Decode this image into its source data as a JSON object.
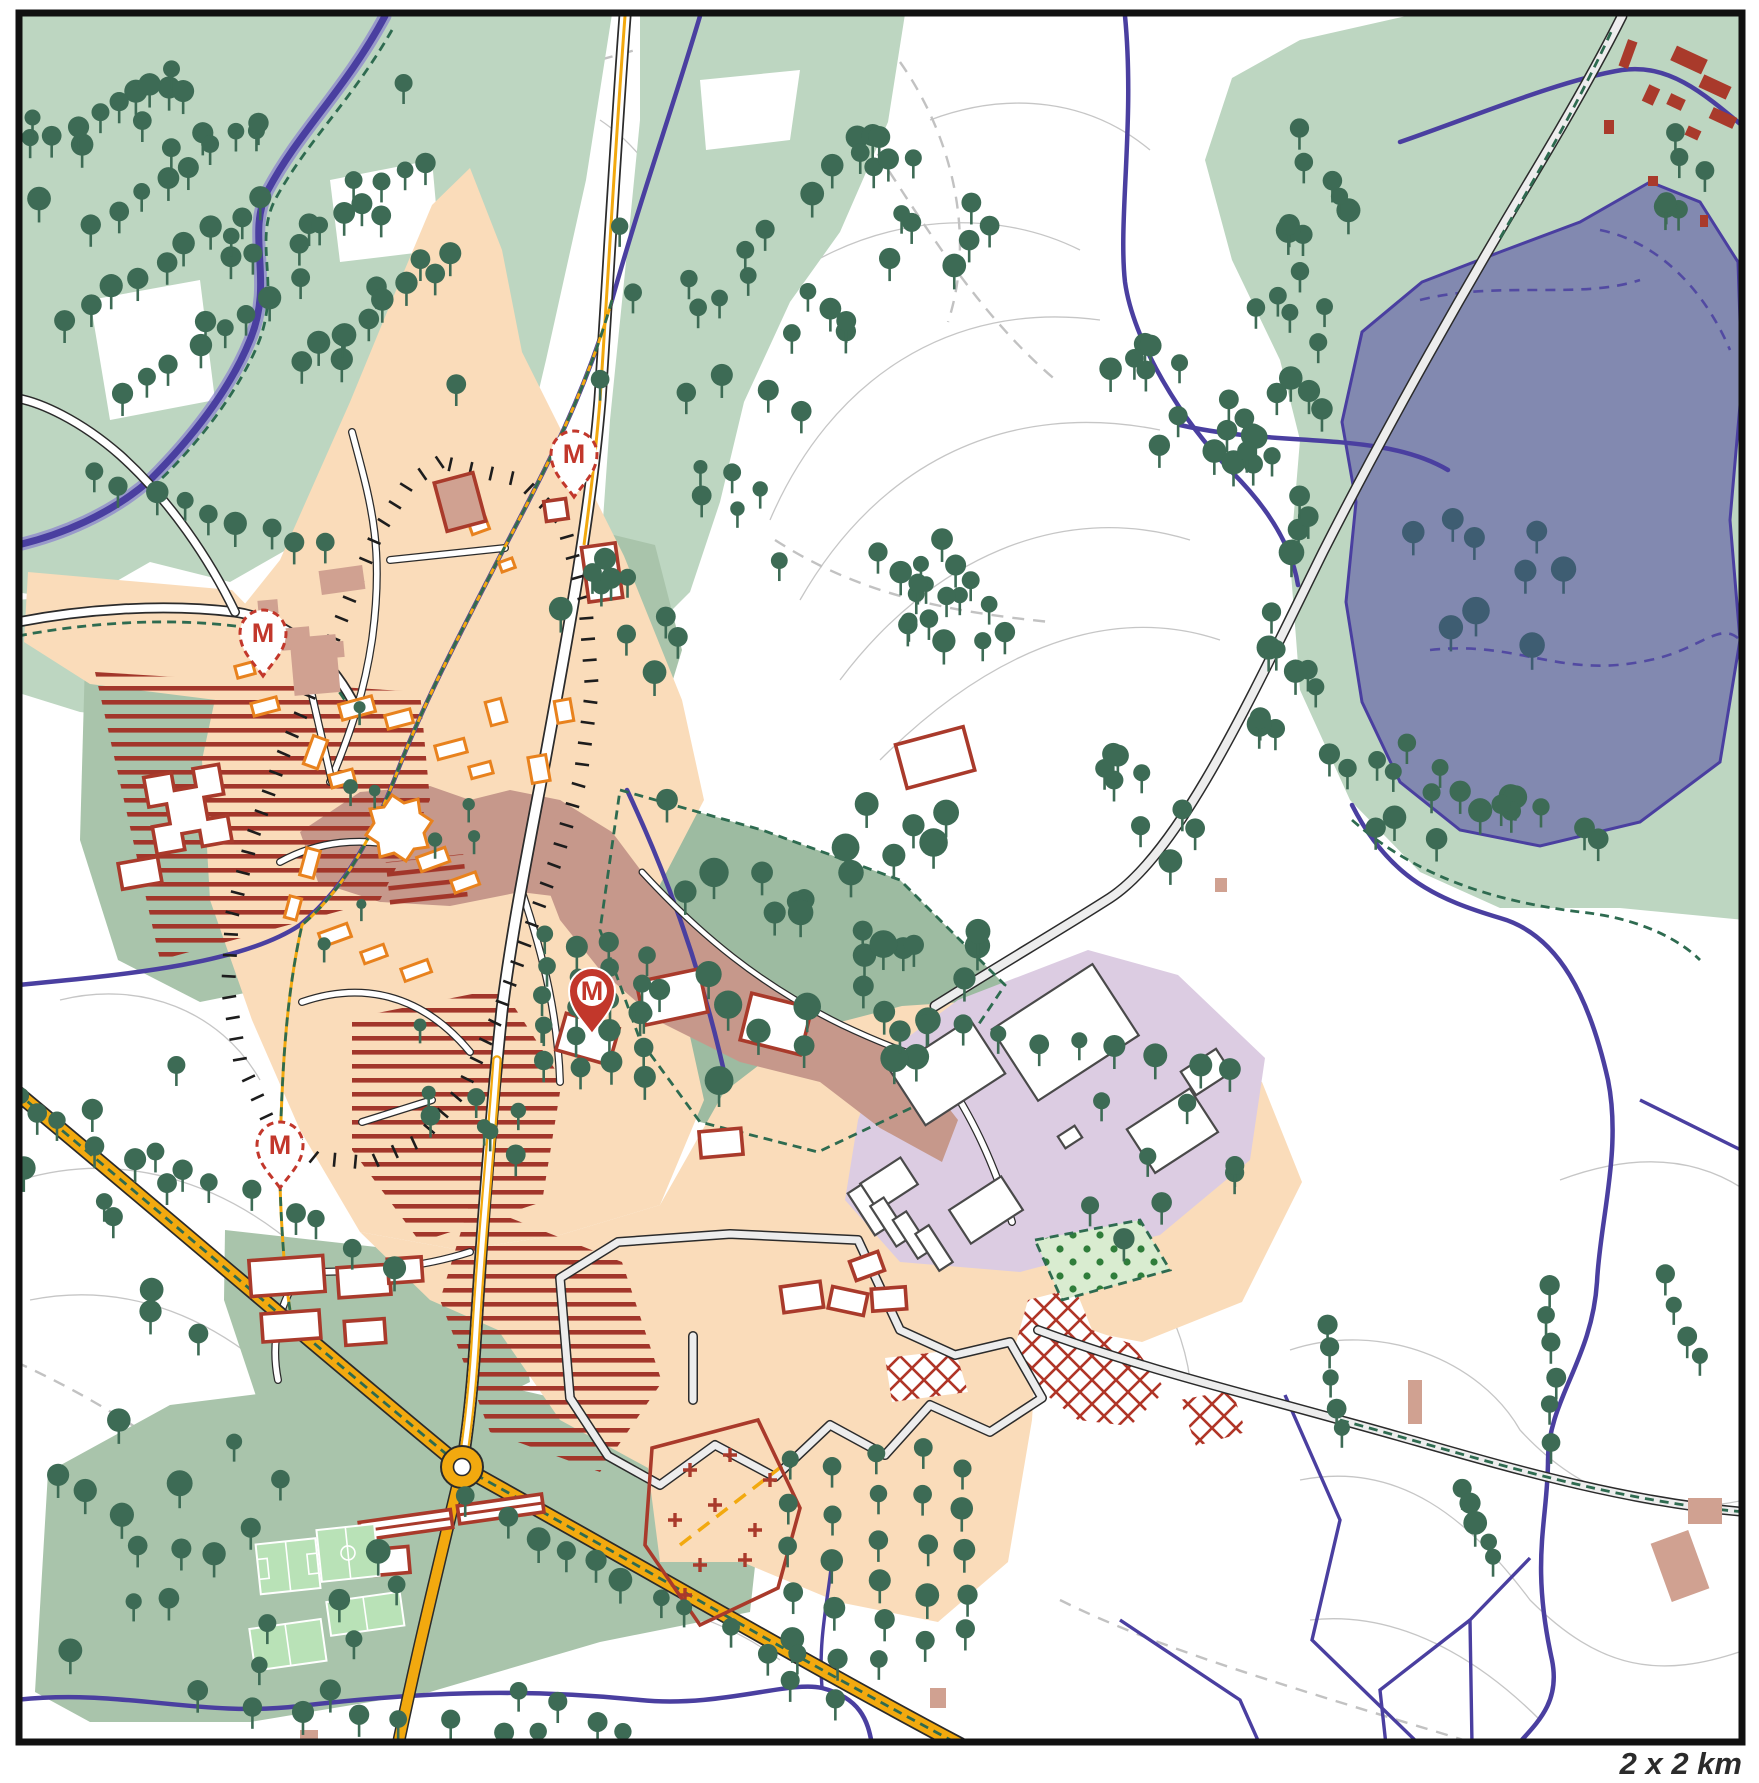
{
  "map": {
    "scale_label": "2 x 2 km",
    "marker_letter": "M",
    "markers": [
      {
        "x": 574,
        "y": 497,
        "style": "dashed"
      },
      {
        "x": 263,
        "y": 676,
        "style": "dashed"
      },
      {
        "x": 280,
        "y": 1188,
        "style": "dashed"
      },
      {
        "x": 592,
        "y": 1034,
        "style": "solid"
      }
    ],
    "colors": {
      "paper": "#ffffff",
      "frame": "#111111",
      "forest": "#bdd6c1",
      "park": "#a9c4ab",
      "parkDense": "#9dbba1",
      "lake": "#8289b0",
      "lakeLine": "#4a3fa0",
      "river": "#4a3fa0",
      "riverHalo": "#8d85cc",
      "roadYellow": "#f2a90f",
      "roadCase": "#2b2b2b",
      "roadPale": "#ededed",
      "urban": "#fadcba",
      "urbanOld": "#c6988b",
      "industrial": "#dccce2",
      "bldOrange": "#e8821e",
      "bldRed": "#a93a2b",
      "bldRose": "#d0a191",
      "pitch": "#b9e2b7",
      "orchard": "#d9ecd0",
      "orchardDot": "#2f7d3a",
      "tree": "#3d6b55",
      "treeSlate": "#3e5d72",
      "contour": "#c6c6c6",
      "dashGreen": "#2e6b50",
      "dashGray": "#c2c2c2",
      "hatchRed": "#a2362a",
      "tick": "#1d1d1d",
      "markerRed": "#c2372b",
      "scaleText": "#2b2b2b"
    },
    "tick_loop": {
      "gap": 21,
      "len": 14,
      "points": [
        [
          440,
          462
        ],
        [
          520,
          480
        ],
        [
          562,
          520
        ],
        [
          585,
          600
        ],
        [
          592,
          690
        ],
        [
          580,
          780
        ],
        [
          556,
          860
        ],
        [
          526,
          940
        ],
        [
          496,
          1020
        ],
        [
          462,
          1090
        ],
        [
          420,
          1140
        ],
        [
          370,
          1163
        ],
        [
          315,
          1158
        ],
        [
          268,
          1120
        ],
        [
          240,
          1060
        ],
        [
          228,
          990
        ],
        [
          232,
          915
        ],
        [
          252,
          838
        ],
        [
          280,
          762
        ],
        [
          308,
          698
        ],
        [
          332,
          642
        ],
        [
          354,
          588
        ],
        [
          378,
          532
        ],
        [
          408,
          484
        ],
        [
          440,
          462
        ]
      ]
    },
    "tree_clusters": [
      {
        "t": "s",
        "x": 30,
        "y": 55,
        "w": 430,
        "h": 370,
        "n": 24,
        "sd": 1,
        "r1": 8,
        "r2": 12
      },
      {
        "t": "r",
        "x1": 55,
        "y1": 140,
        "x2": 170,
        "y2": 68,
        "n": 6,
        "sd": 2,
        "j": 6
      },
      {
        "t": "r",
        "x1": 95,
        "y1": 225,
        "x2": 255,
        "y2": 118,
        "n": 8,
        "sd": 3,
        "j": 6
      },
      {
        "t": "r",
        "x1": 65,
        "y1": 320,
        "x2": 262,
        "y2": 202,
        "n": 9,
        "sd": 4,
        "j": 6
      },
      {
        "t": "r",
        "x1": 122,
        "y1": 392,
        "x2": 300,
        "y2": 278,
        "n": 8,
        "sd": 5,
        "j": 6
      },
      {
        "t": "r",
        "x1": 298,
        "y1": 242,
        "x2": 422,
        "y2": 158,
        "n": 7,
        "sd": 6,
        "j": 6
      },
      {
        "t": "r",
        "x1": 300,
        "y1": 362,
        "x2": 452,
        "y2": 258,
        "n": 8,
        "sd": 7,
        "j": 6
      },
      {
        "t": "r",
        "x1": 95,
        "y1": 470,
        "x2": 330,
        "y2": 548,
        "n": 9,
        "sd": 8,
        "j": 8
      },
      {
        "t": "s",
        "x": 600,
        "y": 225,
        "w": 255,
        "h": 205,
        "n": 18,
        "sd": 9,
        "r1": 8,
        "r2": 12
      },
      {
        "t": "s",
        "x": 808,
        "y": 118,
        "w": 200,
        "h": 195,
        "n": 16,
        "sd": 10,
        "r1": 8,
        "r2": 12
      },
      {
        "t": "r",
        "x1": 882,
        "y1": 548,
        "x2": 948,
        "y2": 638,
        "n": 5,
        "sd": 11,
        "j": 5
      },
      {
        "t": "r",
        "x1": 938,
        "y1": 540,
        "x2": 1002,
        "y2": 628,
        "n": 5,
        "sd": 12,
        "j": 5
      },
      {
        "t": "s",
        "x": 1090,
        "y": 330,
        "w": 170,
        "h": 160,
        "n": 12,
        "sd": 13,
        "r1": 8,
        "r2": 12
      },
      {
        "t": "s",
        "x": 1280,
        "y": 108,
        "w": 95,
        "h": 155,
        "n": 8,
        "sd": 14,
        "r1": 8,
        "r2": 13
      },
      {
        "t": "s",
        "x": 1243,
        "y": 250,
        "w": 100,
        "h": 175,
        "n": 10,
        "sd": 15,
        "r1": 8,
        "r2": 13
      },
      {
        "t": "s",
        "x": 1222,
        "y": 420,
        "w": 95,
        "h": 175,
        "n": 10,
        "sd": 16,
        "r1": 8,
        "r2": 13
      },
      {
        "t": "s",
        "x": 1250,
        "y": 590,
        "w": 105,
        "h": 170,
        "n": 10,
        "sd": 17,
        "r1": 8,
        "r2": 13
      },
      {
        "t": "s",
        "x": 1330,
        "y": 728,
        "w": 135,
        "h": 122,
        "n": 10,
        "sd": 18,
        "r1": 8,
        "r2": 13
      },
      {
        "t": "s",
        "x": 1462,
        "y": 788,
        "w": 150,
        "h": 92,
        "n": 8,
        "sd": 19,
        "r1": 8,
        "r2": 13
      },
      {
        "t": "s",
        "x": 1658,
        "y": 118,
        "w": 85,
        "h": 112,
        "n": 6,
        "sd": 20,
        "r1": 8,
        "r2": 12
      },
      {
        "t": "s",
        "x": 1390,
        "y": 468,
        "w": 180,
        "h": 195,
        "n": 9,
        "sd": 21,
        "r1": 10,
        "r2": 15,
        "c": "slate"
      },
      {
        "t": "s",
        "x": 1068,
        "y": 740,
        "w": 140,
        "h": 160,
        "n": 9,
        "sd": 22,
        "r1": 8,
        "r2": 12
      },
      {
        "t": "s",
        "x": 898,
        "y": 552,
        "w": 112,
        "h": 92,
        "n": 8,
        "sd": 23,
        "r1": 7,
        "r2": 10
      },
      {
        "t": "s",
        "x": 640,
        "y": 798,
        "w": 350,
        "h": 285,
        "n": 36,
        "sd": 24,
        "r1": 10,
        "r2": 15
      },
      {
        "t": "s",
        "x": 558,
        "y": 542,
        "w": 132,
        "h": 172,
        "n": 10,
        "sd": 25,
        "r1": 8,
        "r2": 12
      },
      {
        "t": "s",
        "x": 292,
        "y": 658,
        "w": 330,
        "h": 380,
        "n": 10,
        "sd": 26,
        "r1": 5,
        "r2": 8
      },
      {
        "t": "r",
        "x1": 545,
        "y1": 935,
        "x2": 545,
        "y2": 1058,
        "n": 5,
        "sd": 27,
        "j": 4
      },
      {
        "t": "r",
        "x1": 578,
        "y1": 950,
        "x2": 578,
        "y2": 1068,
        "n": 5,
        "sd": 28,
        "j": 4
      },
      {
        "t": "r",
        "x1": 612,
        "y1": 940,
        "x2": 612,
        "y2": 1062,
        "n": 5,
        "sd": 29,
        "j": 4
      },
      {
        "t": "r",
        "x1": 645,
        "y1": 955,
        "x2": 645,
        "y2": 1075,
        "n": 5,
        "sd": 30,
        "j": 4
      },
      {
        "t": "r",
        "x1": 790,
        "y1": 1462,
        "x2": 790,
        "y2": 1680,
        "n": 6,
        "sd": 31,
        "j": 5
      },
      {
        "t": "r",
        "x1": 835,
        "y1": 1470,
        "x2": 835,
        "y2": 1700,
        "n": 6,
        "sd": 32,
        "j": 5
      },
      {
        "t": "r",
        "x1": 880,
        "y1": 1455,
        "x2": 880,
        "y2": 1660,
        "n": 6,
        "sd": 33,
        "j": 5
      },
      {
        "t": "r",
        "x1": 925,
        "y1": 1450,
        "x2": 925,
        "y2": 1640,
        "n": 5,
        "sd": 34,
        "j": 5
      },
      {
        "t": "r",
        "x1": 965,
        "y1": 1470,
        "x2": 965,
        "y2": 1630,
        "n": 5,
        "sd": 35,
        "j": 5
      },
      {
        "t": "r",
        "x1": 60,
        "y1": 1125,
        "x2": 400,
        "y2": 1258,
        "n": 10,
        "sd": 36,
        "j": 10
      },
      {
        "t": "r",
        "x1": 470,
        "y1": 1502,
        "x2": 790,
        "y2": 1662,
        "n": 11,
        "sd": 37,
        "j": 10
      },
      {
        "t": "s",
        "x": 58,
        "y": 1420,
        "w": 360,
        "h": 280,
        "n": 22,
        "sd": 38,
        "r1": 8,
        "r2": 13
      },
      {
        "t": "r",
        "x1": 255,
        "y1": 1702,
        "x2": 690,
        "y2": 1758,
        "n": 10,
        "sd": 39,
        "j": 8
      },
      {
        "t": "s",
        "x": 20,
        "y": 1040,
        "w": 180,
        "h": 330,
        "n": 12,
        "sd": 40,
        "r1": 8,
        "r2": 12
      },
      {
        "t": "r",
        "x1": 885,
        "y1": 1012,
        "x2": 1235,
        "y2": 1072,
        "n": 10,
        "sd": 41,
        "j": 6
      },
      {
        "t": "s",
        "x": 1090,
        "y": 1100,
        "w": 150,
        "h": 140,
        "n": 8,
        "sd": 42,
        "r1": 8,
        "r2": 11
      },
      {
        "t": "s",
        "x": 428,
        "y": 1075,
        "w": 120,
        "h": 105,
        "n": 7,
        "sd": 43,
        "r1": 7,
        "r2": 10
      },
      {
        "t": "r",
        "x1": 1325,
        "y1": 1320,
        "x2": 1342,
        "y2": 1432,
        "n": 5,
        "sd": 44,
        "j": 5
      },
      {
        "t": "r",
        "x1": 1545,
        "y1": 1285,
        "x2": 1556,
        "y2": 1440,
        "n": 6,
        "sd": 45,
        "j": 5
      },
      {
        "t": "r",
        "x1": 1462,
        "y1": 1488,
        "x2": 1498,
        "y2": 1560,
        "n": 5,
        "sd": 46,
        "j": 5
      },
      {
        "t": "r",
        "x1": 1665,
        "y1": 1275,
        "x2": 1700,
        "y2": 1360,
        "n": 4,
        "sd": 47,
        "j": 5
      },
      {
        "t": "r",
        "x1": 520,
        "y1": 1692,
        "x2": 700,
        "y2": 1768,
        "n": 6,
        "sd": 48,
        "j": 6
      },
      {
        "t": "s",
        "x": 700,
        "y": 445,
        "w": 80,
        "h": 130,
        "n": 6,
        "sd": 49,
        "r1": 7,
        "r2": 10
      }
    ]
  }
}
